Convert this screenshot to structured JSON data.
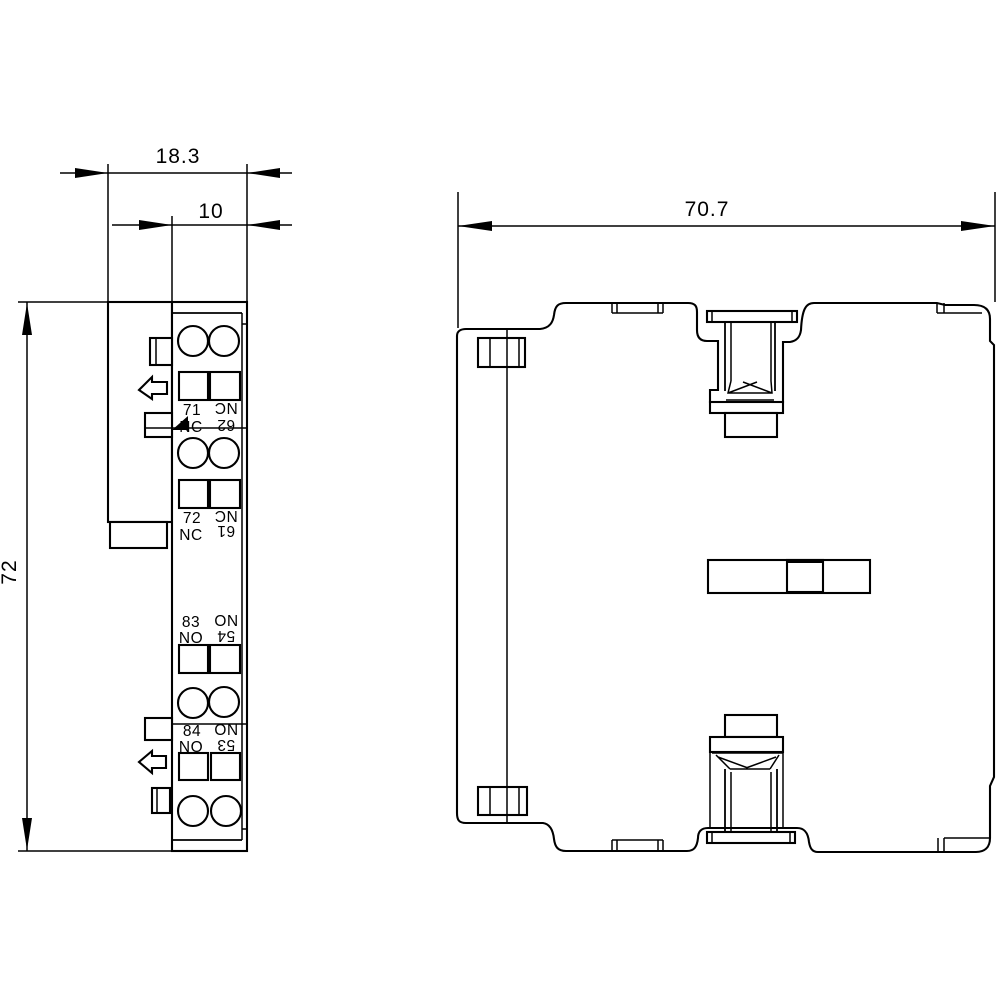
{
  "dimensions": {
    "side_width_total": "18.3",
    "side_width_body": "10",
    "side_height": "72",
    "front_width": "70.7"
  },
  "terminals": {
    "groups": [
      {
        "left_num": "71",
        "left_type": "NC",
        "right_num": "62",
        "right_type": "NC"
      },
      {
        "left_num": "72",
        "left_type": "NC",
        "right_num": "61",
        "right_type": "NC"
      },
      {
        "left_num": "83",
        "left_type": "NO",
        "right_num": "54",
        "right_type": "NO"
      },
      {
        "left_num": "84",
        "left_type": "NO",
        "right_num": "53",
        "right_type": "NO"
      }
    ]
  },
  "colors": {
    "line": "#000000",
    "background": "#ffffff"
  }
}
